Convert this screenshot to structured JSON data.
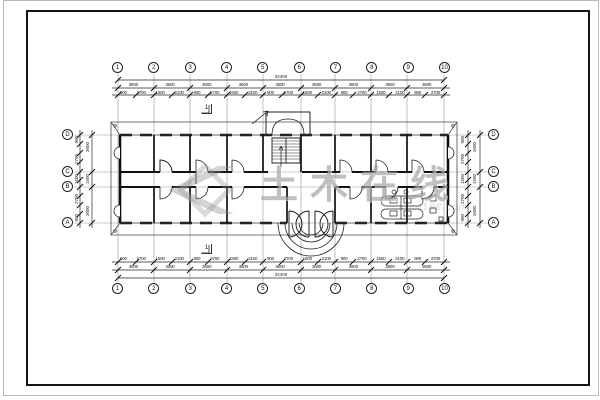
{
  "sheet": {
    "background": "#ffffff",
    "frame_color": "#141414",
    "edge_color": "#b8b8b8",
    "line_color": "#111111"
  },
  "grids": {
    "top": [
      "1",
      "2",
      "3",
      "4",
      "5",
      "6",
      "7",
      "8",
      "9",
      "10"
    ],
    "bottom": [
      "1",
      "2",
      "3",
      "4",
      "5",
      "6",
      "7",
      "8",
      "9",
      "10"
    ],
    "left": [
      "D",
      "C",
      "B",
      "A"
    ],
    "right": [
      "D",
      "C",
      "B",
      "A"
    ]
  },
  "dims": {
    "top_overall": "32400",
    "top_majors": [
      "3600",
      "3600",
      "3600",
      "3600",
      "3600",
      "3600",
      "3600",
      "3600",
      "3600"
    ],
    "top_details": [
      "900",
      "2700",
      "1500",
      "2100",
      "900",
      "2700",
      "1500",
      "2100",
      "900",
      "2700",
      "1500",
      "2100",
      "900",
      "2700",
      "1500",
      "2100",
      "900",
      "2700"
    ],
    "bottom_overall": "32400",
    "bottom_majors": [
      "3600",
      "3600",
      "3600",
      "3600",
      "3600",
      "3600",
      "3600",
      "3600",
      "3600"
    ],
    "bottom_details": [
      "900",
      "2700",
      "1500",
      "2100",
      "900",
      "2700",
      "1500",
      "2100",
      "900",
      "2700",
      "1500",
      "2100",
      "900",
      "2700",
      "1500",
      "2100",
      "900",
      "2700"
    ],
    "left_majors": [
      "3600",
      "1500",
      "3600"
    ],
    "left_details": [
      "900",
      "2700",
      "1500",
      "2700",
      "900"
    ],
    "right_majors": [
      "3600",
      "1500",
      "3600"
    ],
    "right_details": [
      "900",
      "2700",
      "1500",
      "2700",
      "900"
    ]
  },
  "section_marks": {
    "top": "1",
    "bottom": "1"
  },
  "watermark": {
    "text": "土木在线",
    "subtext": "co188.com"
  }
}
